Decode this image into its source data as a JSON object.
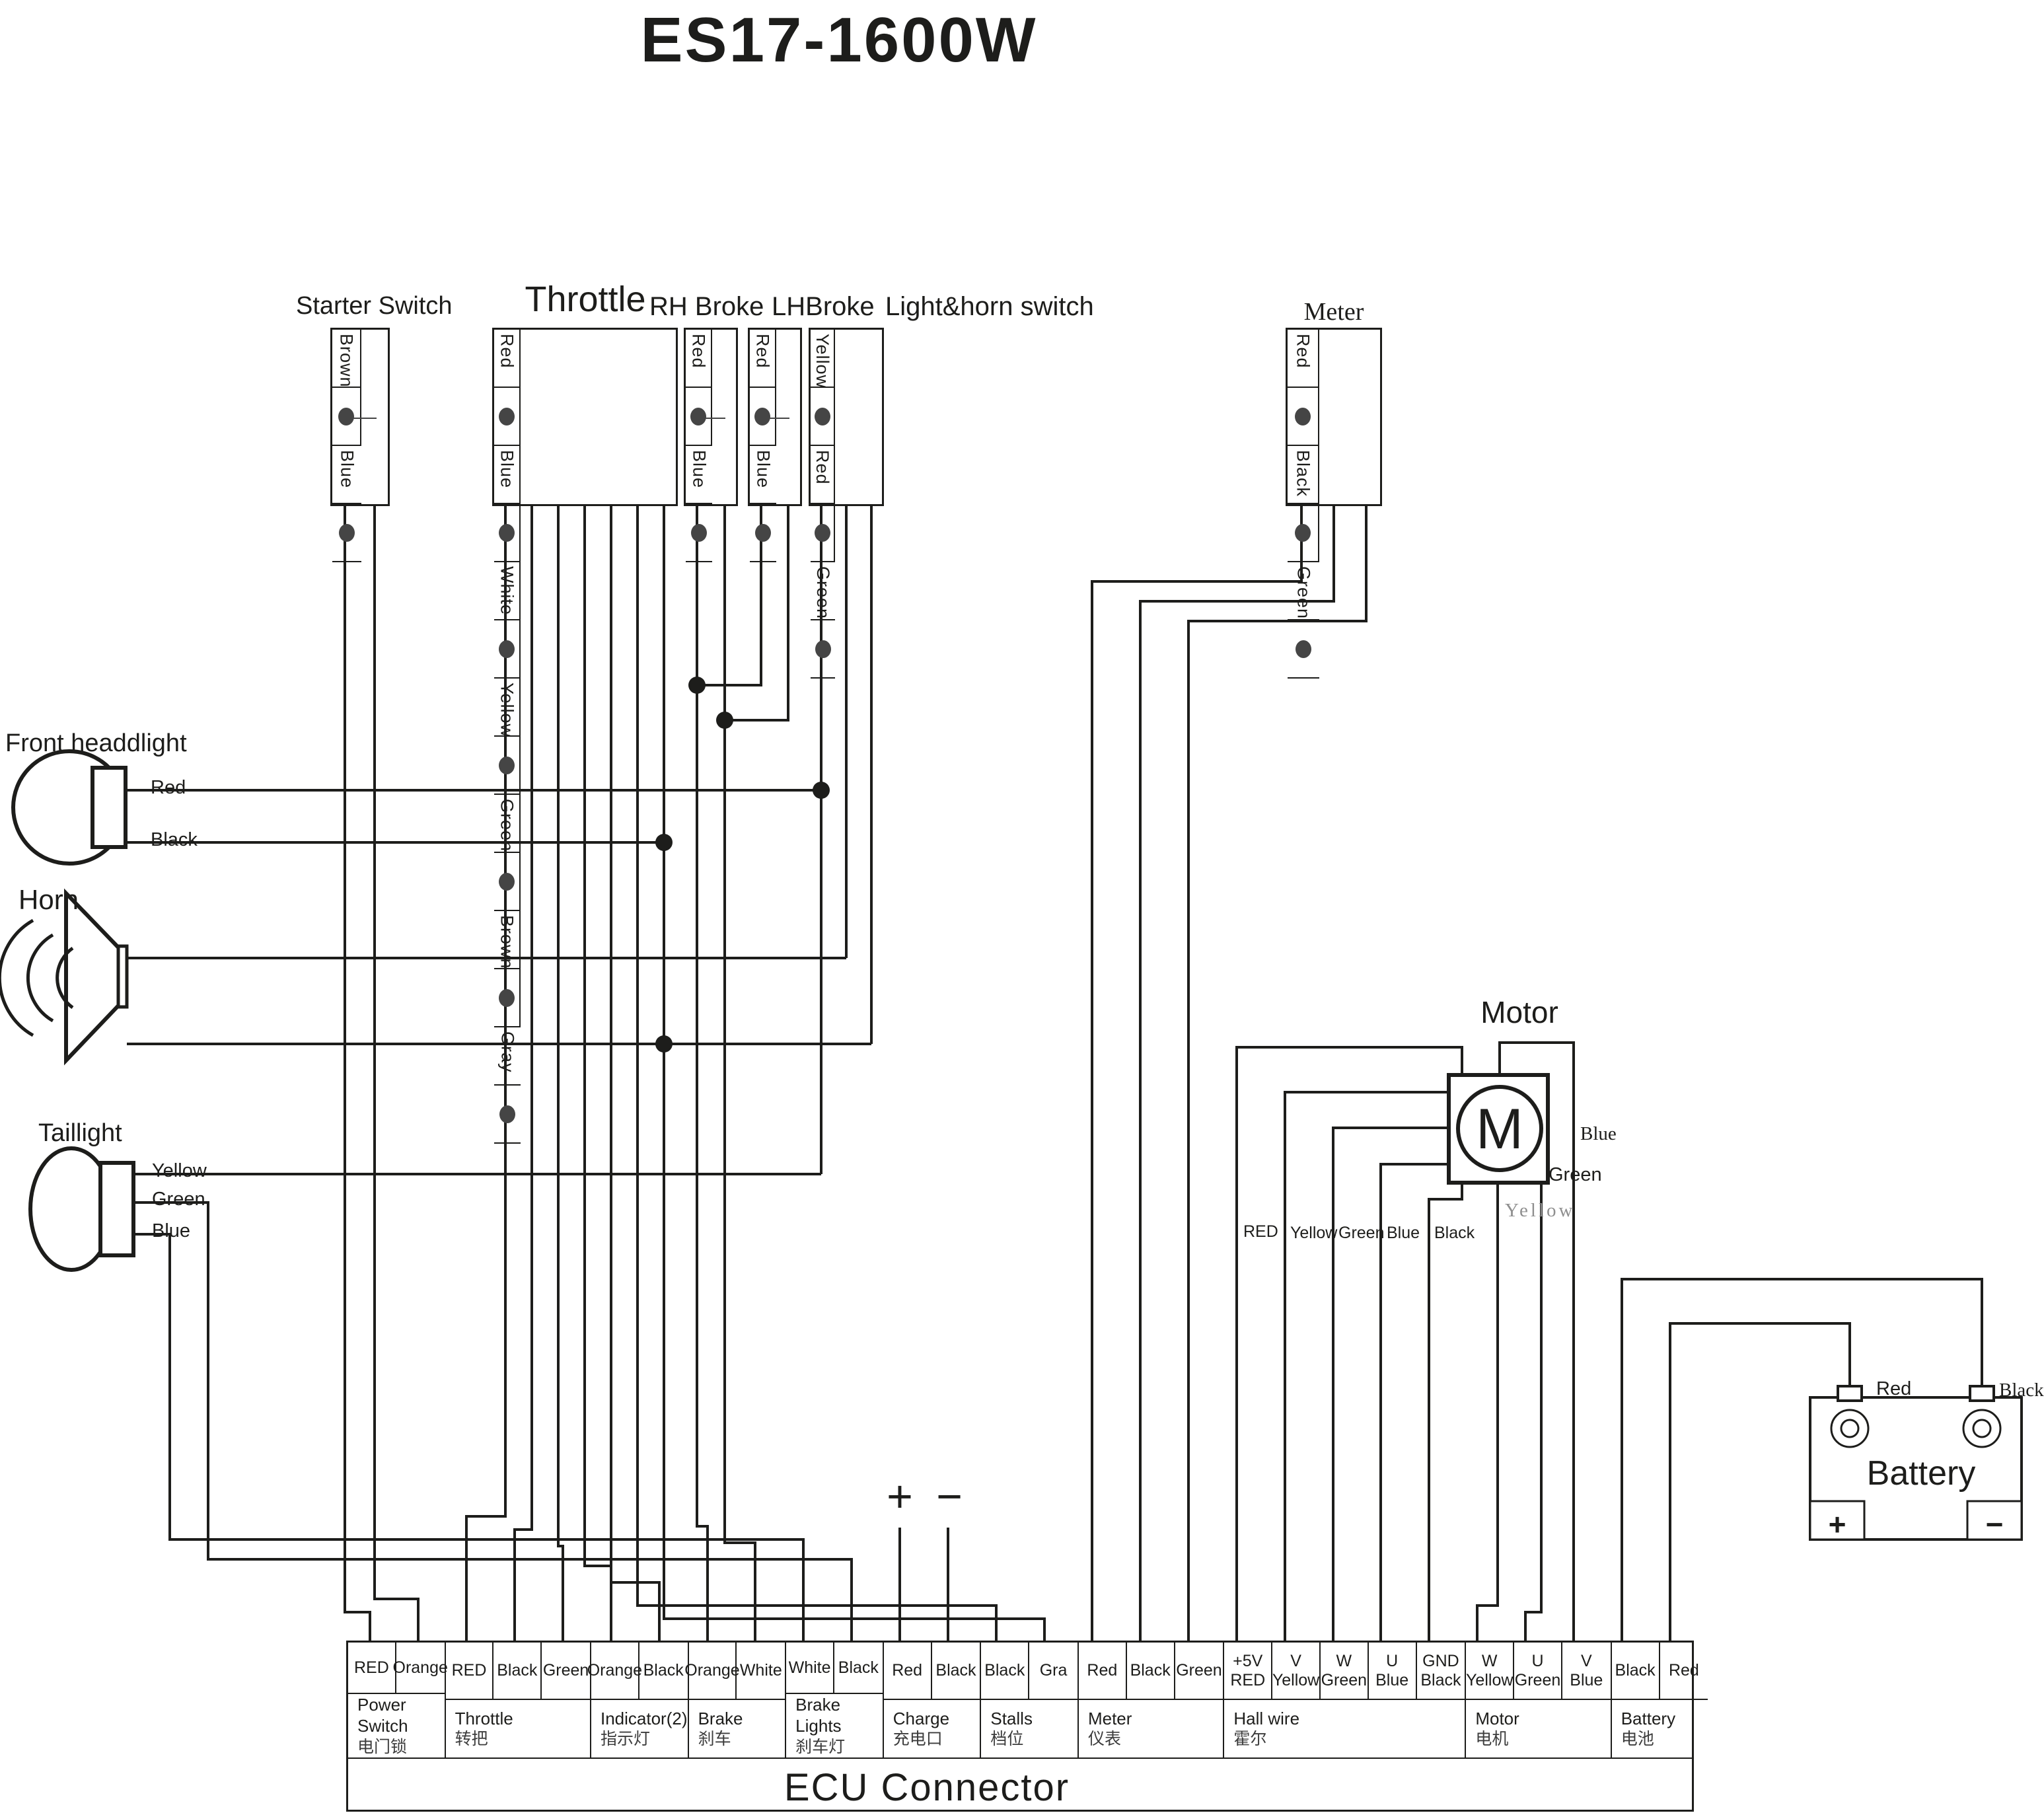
{
  "title": "ES17-1600W",
  "top_connectors": {
    "starter_switch": {
      "label": "Starter Switch",
      "pins": [
        "Brown",
        "Blue"
      ]
    },
    "throttle": {
      "label": "Throttle",
      "pins": [
        "Red",
        "Blue",
        "White",
        "Yellow",
        "Green",
        "Brown",
        "Gray"
      ]
    },
    "rh_broke": {
      "label": "RH Broke",
      "pins": [
        "Red",
        "Blue"
      ]
    },
    "lh_broke": {
      "label": "LHBroke",
      "pins": [
        "Red",
        "Blue"
      ]
    },
    "light_horn_switch": {
      "label": "Light&horn switch",
      "pins": [
        "Yellow",
        "Red",
        "Green"
      ]
    },
    "meter": {
      "label": "Meter",
      "pins": [
        "Red",
        "Black",
        "Green"
      ]
    }
  },
  "components": {
    "front_headlight": {
      "label": "Front headdlight",
      "wires": [
        "Red",
        "Black"
      ]
    },
    "horn": {
      "label": "Horn"
    },
    "taillight": {
      "label": "Taillight",
      "wires": [
        "Yellow",
        "Green",
        "Blue"
      ]
    },
    "motor": {
      "label": "Motor",
      "symbol": "M",
      "hall_wires": [
        "RED",
        "Yellow",
        "Green",
        "Blue",
        "Black"
      ],
      "phase_wires": [
        "Blue",
        "Green",
        "Yellow"
      ]
    },
    "battery": {
      "label": "Battery",
      "terminals": [
        "Red",
        "Black"
      ],
      "plus": "+",
      "minus": "−"
    },
    "charge": {
      "plus": "+",
      "minus": "−"
    }
  },
  "ecu": {
    "title": "ECU  Connector",
    "groups": [
      {
        "name": "Power Switch",
        "name_cn": "电门锁",
        "pins": [
          "RED",
          "Orange"
        ]
      },
      {
        "name": "Throttle",
        "name_cn": "转把",
        "pins": [
          "RED",
          "Black",
          "Green"
        ]
      },
      {
        "name": "Indicator(2)",
        "name_cn": "指示灯",
        "pins": [
          "Orange",
          "Black"
        ]
      },
      {
        "name": "Brake",
        "name_cn": "刹车",
        "pins": [
          "Orange",
          "White"
        ]
      },
      {
        "name": "Brake Lights",
        "name_cn": "刹车灯",
        "pins": [
          "White",
          "Black"
        ]
      },
      {
        "name": "Charge",
        "name_cn": "充电口",
        "pins": [
          "Red",
          "Black"
        ]
      },
      {
        "name": "Stalls",
        "name_cn": "档位",
        "pins": [
          "Black",
          "Gra"
        ]
      },
      {
        "name": "Meter",
        "name_cn": "仪表",
        "pins": [
          "Red",
          "Black",
          "Green"
        ]
      },
      {
        "name": "Hall wire",
        "name_cn": "霍尔",
        "pins": [
          "+5V\nRED",
          "V\nYellow",
          "W\nGreen",
          "U\nBlue",
          "GND\nBlack"
        ]
      },
      {
        "name": "Motor",
        "name_cn": "电机",
        "pins": [
          "W\nYellow",
          "U\nGreen",
          "V\nBlue"
        ]
      },
      {
        "name": "Battery",
        "name_cn": "电池",
        "pins": [
          "Black",
          "Red"
        ]
      }
    ]
  }
}
